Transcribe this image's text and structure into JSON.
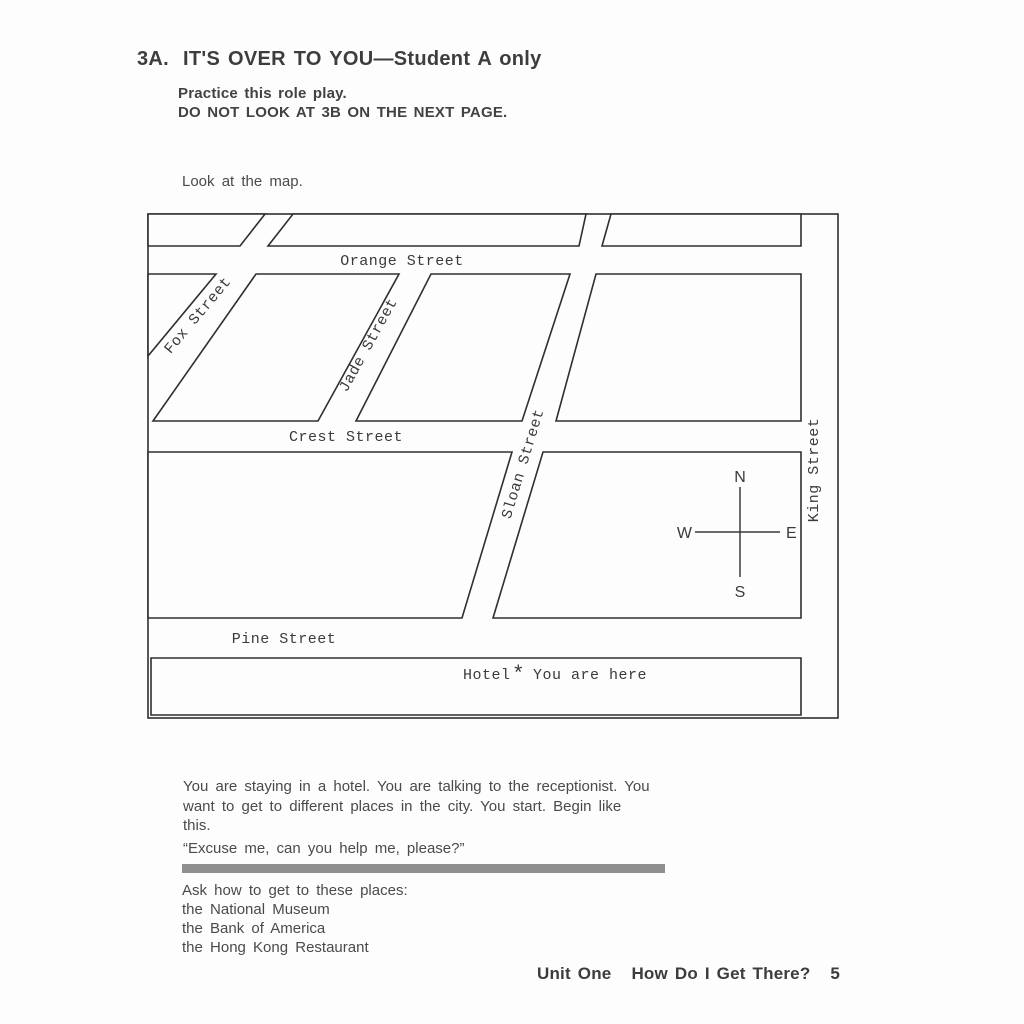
{
  "header": {
    "section_number": "3A.",
    "title": "IT'S OVER TO YOU—Student A only",
    "instruction1": "Practice this role play.",
    "instruction2": "DO NOT LOOK AT 3B ON THE NEXT PAGE.",
    "map_caption": "Look at the map."
  },
  "map": {
    "streets": {
      "orange": "Orange Street",
      "fox": "Fox Street",
      "jade": "Jade Street",
      "crest": "Crest Street",
      "sloan": "Sloan Street",
      "king": "King Street",
      "pine": "Pine Street"
    },
    "hotel_label": "Hotel",
    "marker": "*",
    "you_are_here": "You are here",
    "compass": {
      "north": "N",
      "south": "S",
      "east": "E",
      "west": "W"
    }
  },
  "body": {
    "paragraph_lines": [
      "You are staying in a hotel. You are talking to the receptionist. You",
      "want to get to different places in the city. You start. Begin like",
      "this."
    ],
    "quote": "“Excuse me, can you help me, please?”",
    "ask_heading": "Ask how to get to these places:",
    "places": [
      "the National Museum",
      "the Bank of America",
      "the Hong Kong Restaurant"
    ]
  },
  "footer": {
    "unit": "Unit One",
    "book_title": "How Do I Get There?",
    "page_number": "5"
  },
  "colors": {
    "text": "#474747",
    "map_line": "#2f2f2f",
    "divider_bar": "#8f8f8f"
  }
}
